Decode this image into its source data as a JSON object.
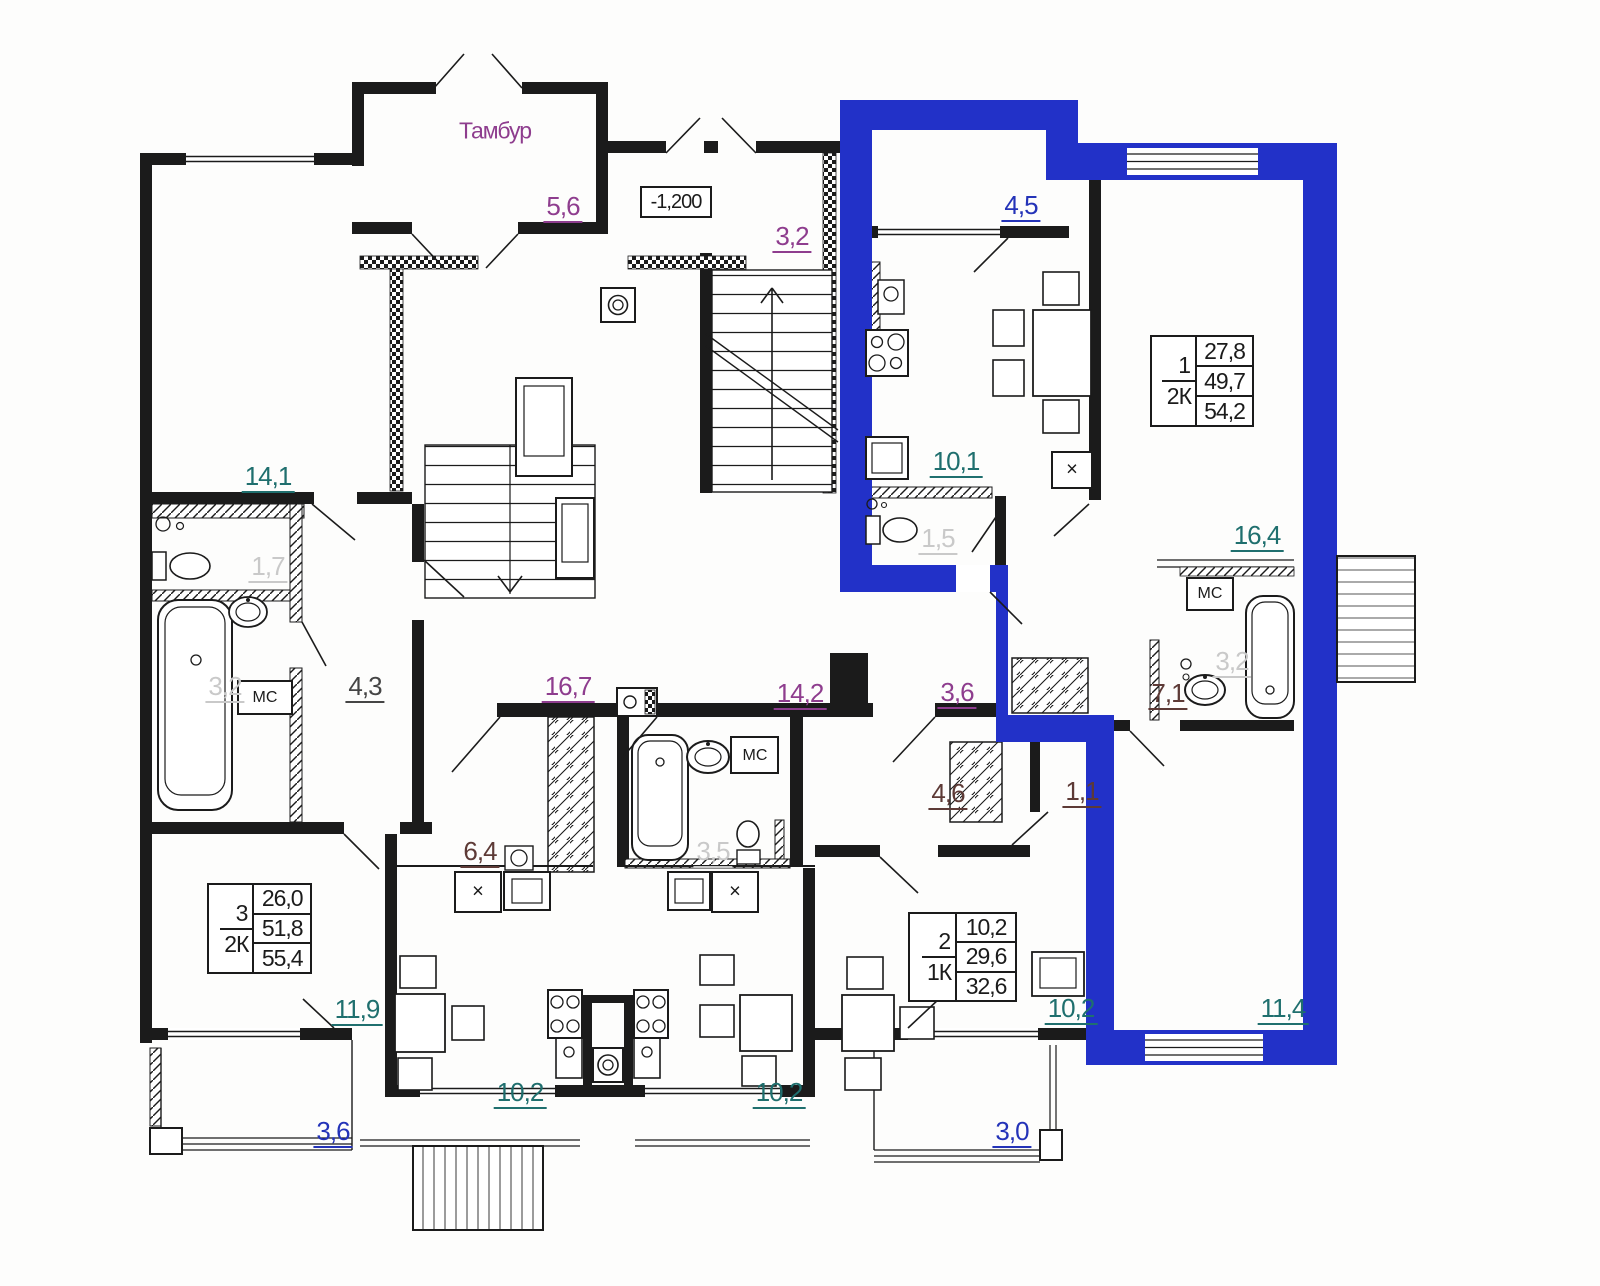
{
  "colors": {
    "highlight_blue": "#2231c8",
    "wall_black": "#1b1b1b",
    "label_purple": "#8e3d8e",
    "label_teal": "#1f6f6e",
    "label_blue": "#2433b8",
    "label_maroon": "#5d3a36",
    "label_gray": "#c9c9c9",
    "label_dark": "#454545"
  },
  "plan": {
    "vestibule_label": "Тамбур",
    "elevation_mark": "-1,200",
    "storage_label": "МС",
    "fridge_mark": "×"
  },
  "room_areas": {
    "vestibule": "5,6",
    "stairwell": "3,2",
    "balcony_top": "4,5",
    "kitchen_apt1": "10,1",
    "wc_apt1": "1,5",
    "living_apt1": "16,4",
    "room_left_top": "14,1",
    "wc_left": "1,7",
    "bath_left": "3,2",
    "hall_left": "4,3",
    "corridor_left": "16,7",
    "corridor_right": "14,2",
    "corridor_small": "3,6",
    "hall_apt1": "7,1",
    "bath_apt1": "3,2",
    "hall_apt2": "4,6",
    "closet_apt2": "1,1",
    "hall_apt3": "6,4",
    "bath_center": "3,5",
    "room_left_bottom": "11,9",
    "balcony_left": "3,6",
    "kitchen_left": "10,2",
    "kitchen_center": "10,2",
    "kitchen_apt2": "10,2",
    "room_apt1_bottom": "11,4",
    "balcony_right": "3,0"
  },
  "apartments": [
    {
      "number": "1",
      "rooms_type": "2К",
      "living_area": "27,8",
      "usable_area": "49,7",
      "total_area": "54,2"
    },
    {
      "number": "2",
      "rooms_type": "1К",
      "living_area": "10,2",
      "usable_area": "29,6",
      "total_area": "32,6"
    },
    {
      "number": "3",
      "rooms_type": "2К",
      "living_area": "26,0",
      "usable_area": "51,8",
      "total_area": "55,4"
    }
  ]
}
